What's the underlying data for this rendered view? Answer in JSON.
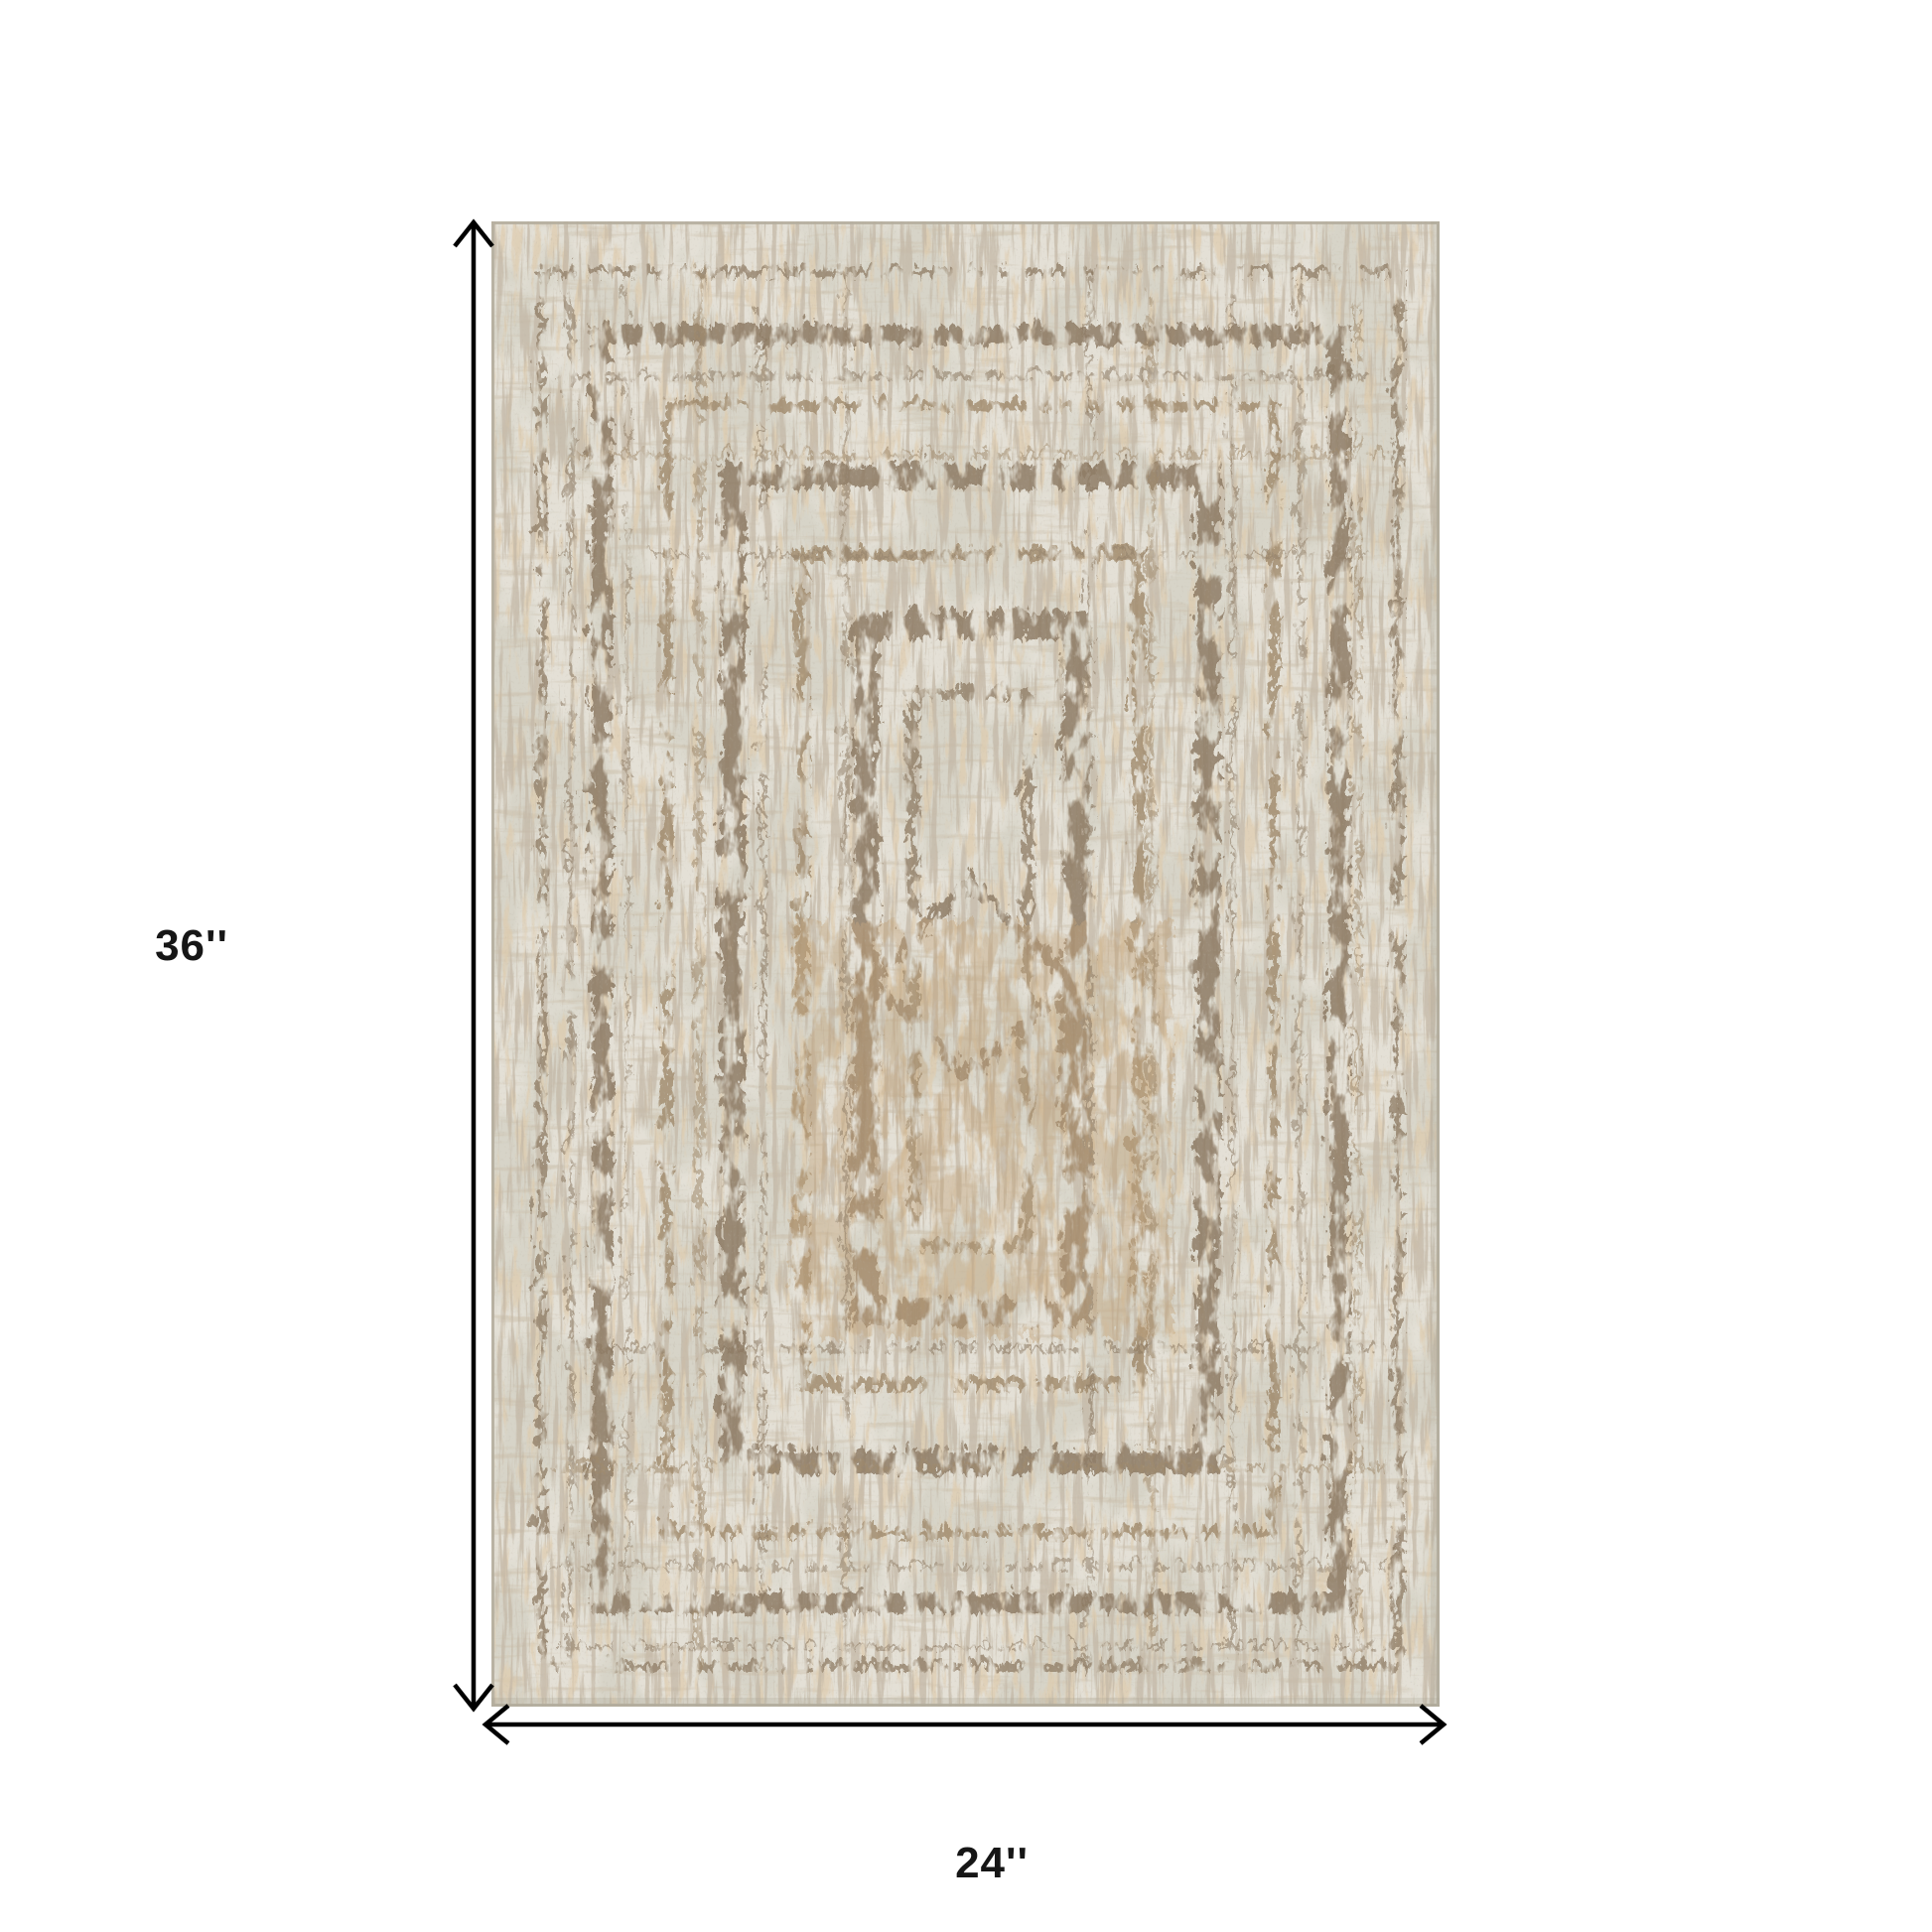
{
  "page": {
    "background_color": "#ffffff",
    "description": "Area rug product photo with dimension annotation"
  },
  "product_image": {
    "name": "distressed-abstract-area-rug",
    "orientation": "portrait",
    "colors": {
      "base": "#d7d4c8",
      "mottle": "#c9c2b0",
      "streak_brown": "#8d7b62",
      "streak_tan": "#bd9a6c",
      "band": "#9a8668",
      "frame_dark": "#8a7760",
      "frame_mid": "#93816a",
      "frame_tan": "#a08a6c",
      "speckle": "#7e7260",
      "edge": "#b5ae9e",
      "shadow": "#a9a294"
    }
  },
  "dimensions": {
    "height_label": "36''",
    "width_label": "24''",
    "arrow_color": "#000000",
    "label_color": "#161616"
  }
}
